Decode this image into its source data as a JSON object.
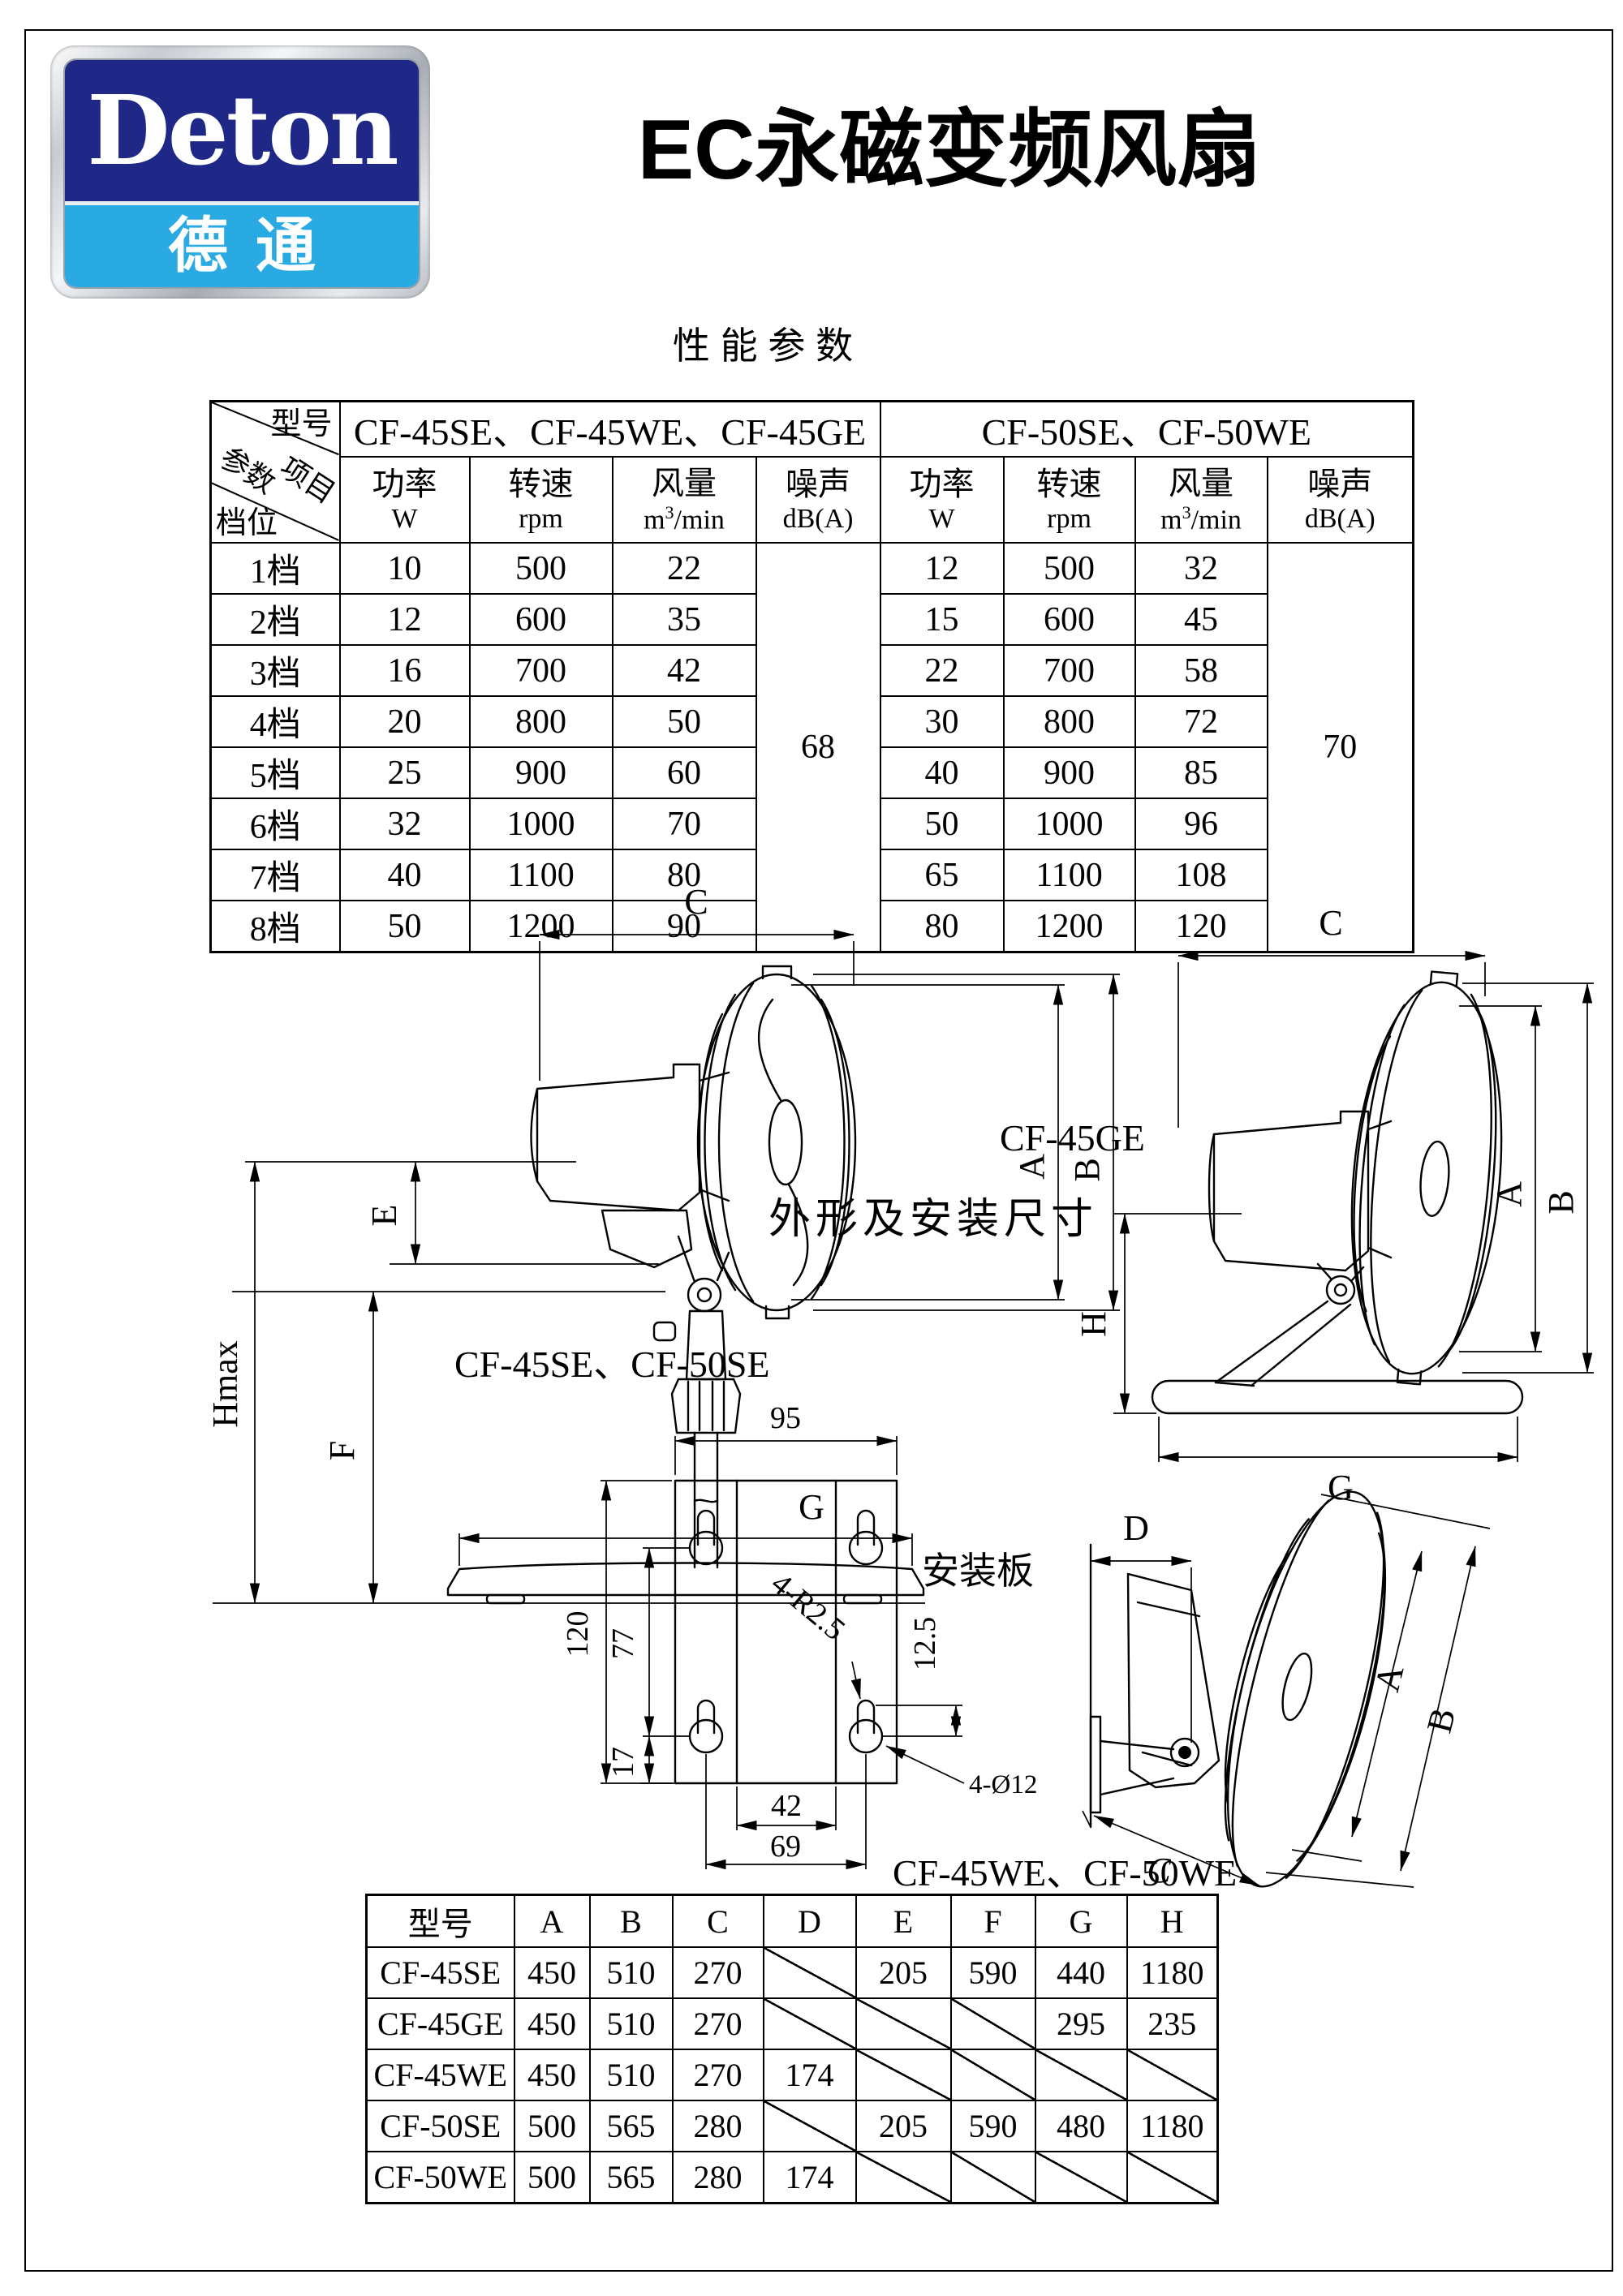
{
  "logo": {
    "name": "Deton",
    "cjk": "德通",
    "navy": "#1f2787",
    "blue": "#29aae3"
  },
  "header": {
    "title": "EC永磁变频风扇",
    "subtitle": "性 能 参 数"
  },
  "perf_table": {
    "corner": {
      "model": "型号",
      "item": "项目",
      "param": "参数",
      "gear": "档位"
    },
    "group1": {
      "models": "CF-45SE、CF-45WE、CF-45GE",
      "noise": "68"
    },
    "group2": {
      "models": "CF-50SE、CF-50WE",
      "noise": "70"
    },
    "headers": {
      "power_cn": "功率",
      "power_unit": "W",
      "speed_cn": "转速",
      "speed_unit": "rpm",
      "airflow_cn": "风量",
      "airflow_unit_base": "m",
      "airflow_unit_sup": "3",
      "airflow_unit_rest": "/min",
      "noise_cn": "噪声",
      "noise_unit": "dB(A)"
    },
    "rows": [
      {
        "gear": "1档",
        "p45": "10",
        "s45": "500",
        "a45": "22",
        "p50": "12",
        "s50": "500",
        "a50": "32"
      },
      {
        "gear": "2档",
        "p45": "12",
        "s45": "600",
        "a45": "35",
        "p50": "15",
        "s50": "600",
        "a50": "45"
      },
      {
        "gear": "3档",
        "p45": "16",
        "s45": "700",
        "a45": "42",
        "p50": "22",
        "s50": "700",
        "a50": "58"
      },
      {
        "gear": "4档",
        "p45": "20",
        "s45": "800",
        "a45": "50",
        "p50": "30",
        "s50": "800",
        "a50": "72"
      },
      {
        "gear": "5档",
        "p45": "25",
        "s45": "900",
        "a45": "60",
        "p50": "40",
        "s50": "900",
        "a50": "85"
      },
      {
        "gear": "6档",
        "p45": "32",
        "s45": "1000",
        "a45": "70",
        "p50": "50",
        "s50": "1000",
        "a50": "96"
      },
      {
        "gear": "7档",
        "p45": "40",
        "s45": "1100",
        "a45": "80",
        "p50": "65",
        "s50": "1100",
        "a50": "108"
      },
      {
        "gear": "8档",
        "p45": "50",
        "s45": "1200",
        "a45": "90",
        "p50": "80",
        "s50": "1200",
        "a50": "120"
      }
    ]
  },
  "drawings": {
    "section_title": "外形及安装尺寸",
    "pedestal": {
      "caption": "CF-45SE、CF-50SE",
      "dim_c": "C",
      "dim_a": "A",
      "dim_b": "B",
      "dim_e": "E",
      "dim_f": "F",
      "dim_g": "G",
      "dim_hmax": "Hmax"
    },
    "desk": {
      "caption": "CF-45GE",
      "dim_c": "C",
      "dim_a": "A",
      "dim_b": "B",
      "dim_h": "H",
      "dim_g": "G"
    },
    "wall": {
      "caption": "CF-45WE、CF-50WE",
      "dim_a": "A",
      "dim_b": "B",
      "dim_c": "C",
      "dim_d": "D"
    },
    "plate": {
      "caption": "安装板",
      "dim_width": "95",
      "dim_height": "120",
      "dim_inner": "77",
      "dim_bottom": "17",
      "dim_slot": "42",
      "dim_holes": "69",
      "dim_offset": "12.5",
      "note_radius": "4-R2.5",
      "note_holes": "4-Ø12"
    }
  },
  "dim_table": {
    "headers": [
      "型号",
      "A",
      "B",
      "C",
      "D",
      "E",
      "F",
      "G",
      "H"
    ],
    "rows": [
      {
        "model": "CF-45SE",
        "A": "450",
        "B": "510",
        "C": "270",
        "D": null,
        "E": "205",
        "F": "590",
        "G": "440",
        "H": "1180"
      },
      {
        "model": "CF-45GE",
        "A": "450",
        "B": "510",
        "C": "270",
        "D": null,
        "E": null,
        "F": null,
        "G": "295",
        "H": "235"
      },
      {
        "model": "CF-45WE",
        "A": "450",
        "B": "510",
        "C": "270",
        "D": "174",
        "E": null,
        "F": null,
        "G": null,
        "H": null
      },
      {
        "model": "CF-50SE",
        "A": "500",
        "B": "565",
        "C": "280",
        "D": null,
        "E": "205",
        "F": "590",
        "G": "480",
        "H": "1180"
      },
      {
        "model": "CF-50WE",
        "A": "500",
        "B": "565",
        "C": "280",
        "D": "174",
        "E": null,
        "F": null,
        "G": null,
        "H": null
      }
    ]
  }
}
